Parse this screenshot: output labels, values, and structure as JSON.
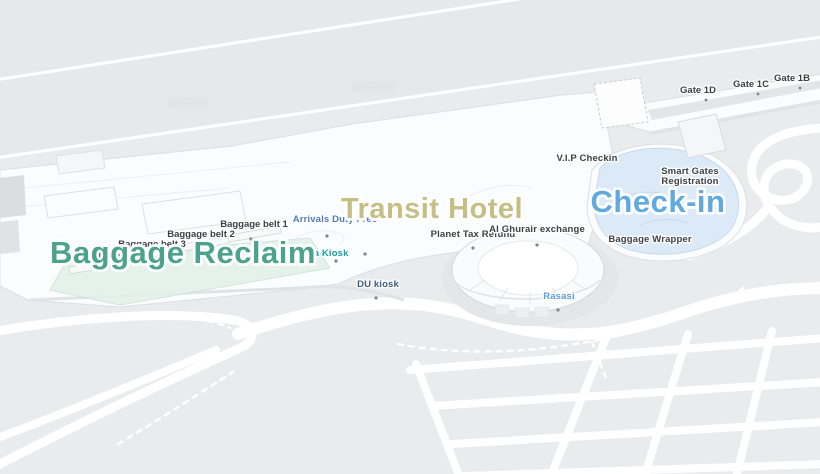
{
  "map": {
    "kind": "airport-terminal-indoor-map",
    "region_labels": [
      {
        "label": "Baggage Reclaim",
        "color": "#4DA28D"
      },
      {
        "label": "Transit Hotel",
        "color": "#C5BE85"
      },
      {
        "label": "Check-in",
        "color": "#5FAADF"
      }
    ],
    "baggage_belts": [
      {
        "label": "Baggage belt 1"
      },
      {
        "label": "Baggage belt 2"
      },
      {
        "label": "Baggage belt 3"
      },
      {
        "label": "Baggage belt 4"
      }
    ],
    "pois": [
      {
        "label": "Arrivals Duty Free",
        "color": "#4D7FB3"
      },
      {
        "label": "Arada Kiosk",
        "color": "#189FA6"
      },
      {
        "label": "DU kiosk",
        "color": "#3D5C85"
      },
      {
        "label": "Planet Tax Refund",
        "color": "#3C4043"
      },
      {
        "label": "Al Ghurair exchange",
        "color": "#3C4043"
      },
      {
        "label": "V.I.P Checkin",
        "color": "#3C4043"
      },
      {
        "label": "Baggage Wrapper",
        "color": "#3C4043"
      },
      {
        "label": "Rasasi",
        "color": "#5C9ED8"
      }
    ],
    "smart_gates": {
      "line1": "Smart Gates",
      "line2": "Registration",
      "color": "#3C4043"
    },
    "gates": [
      {
        "label": "Gate 1D"
      },
      {
        "label": "Gate 1C"
      },
      {
        "label": "Gate 1B"
      }
    ],
    "surface_colors": {
      "ground": "#e9ebed",
      "apron": "#e6e8ea",
      "building": "#fbfcfd",
      "road": "#ffffff",
      "baggage_zone_tint": "#e3f0ea",
      "checkin_zone_tint": "#d9e9f6"
    }
  }
}
